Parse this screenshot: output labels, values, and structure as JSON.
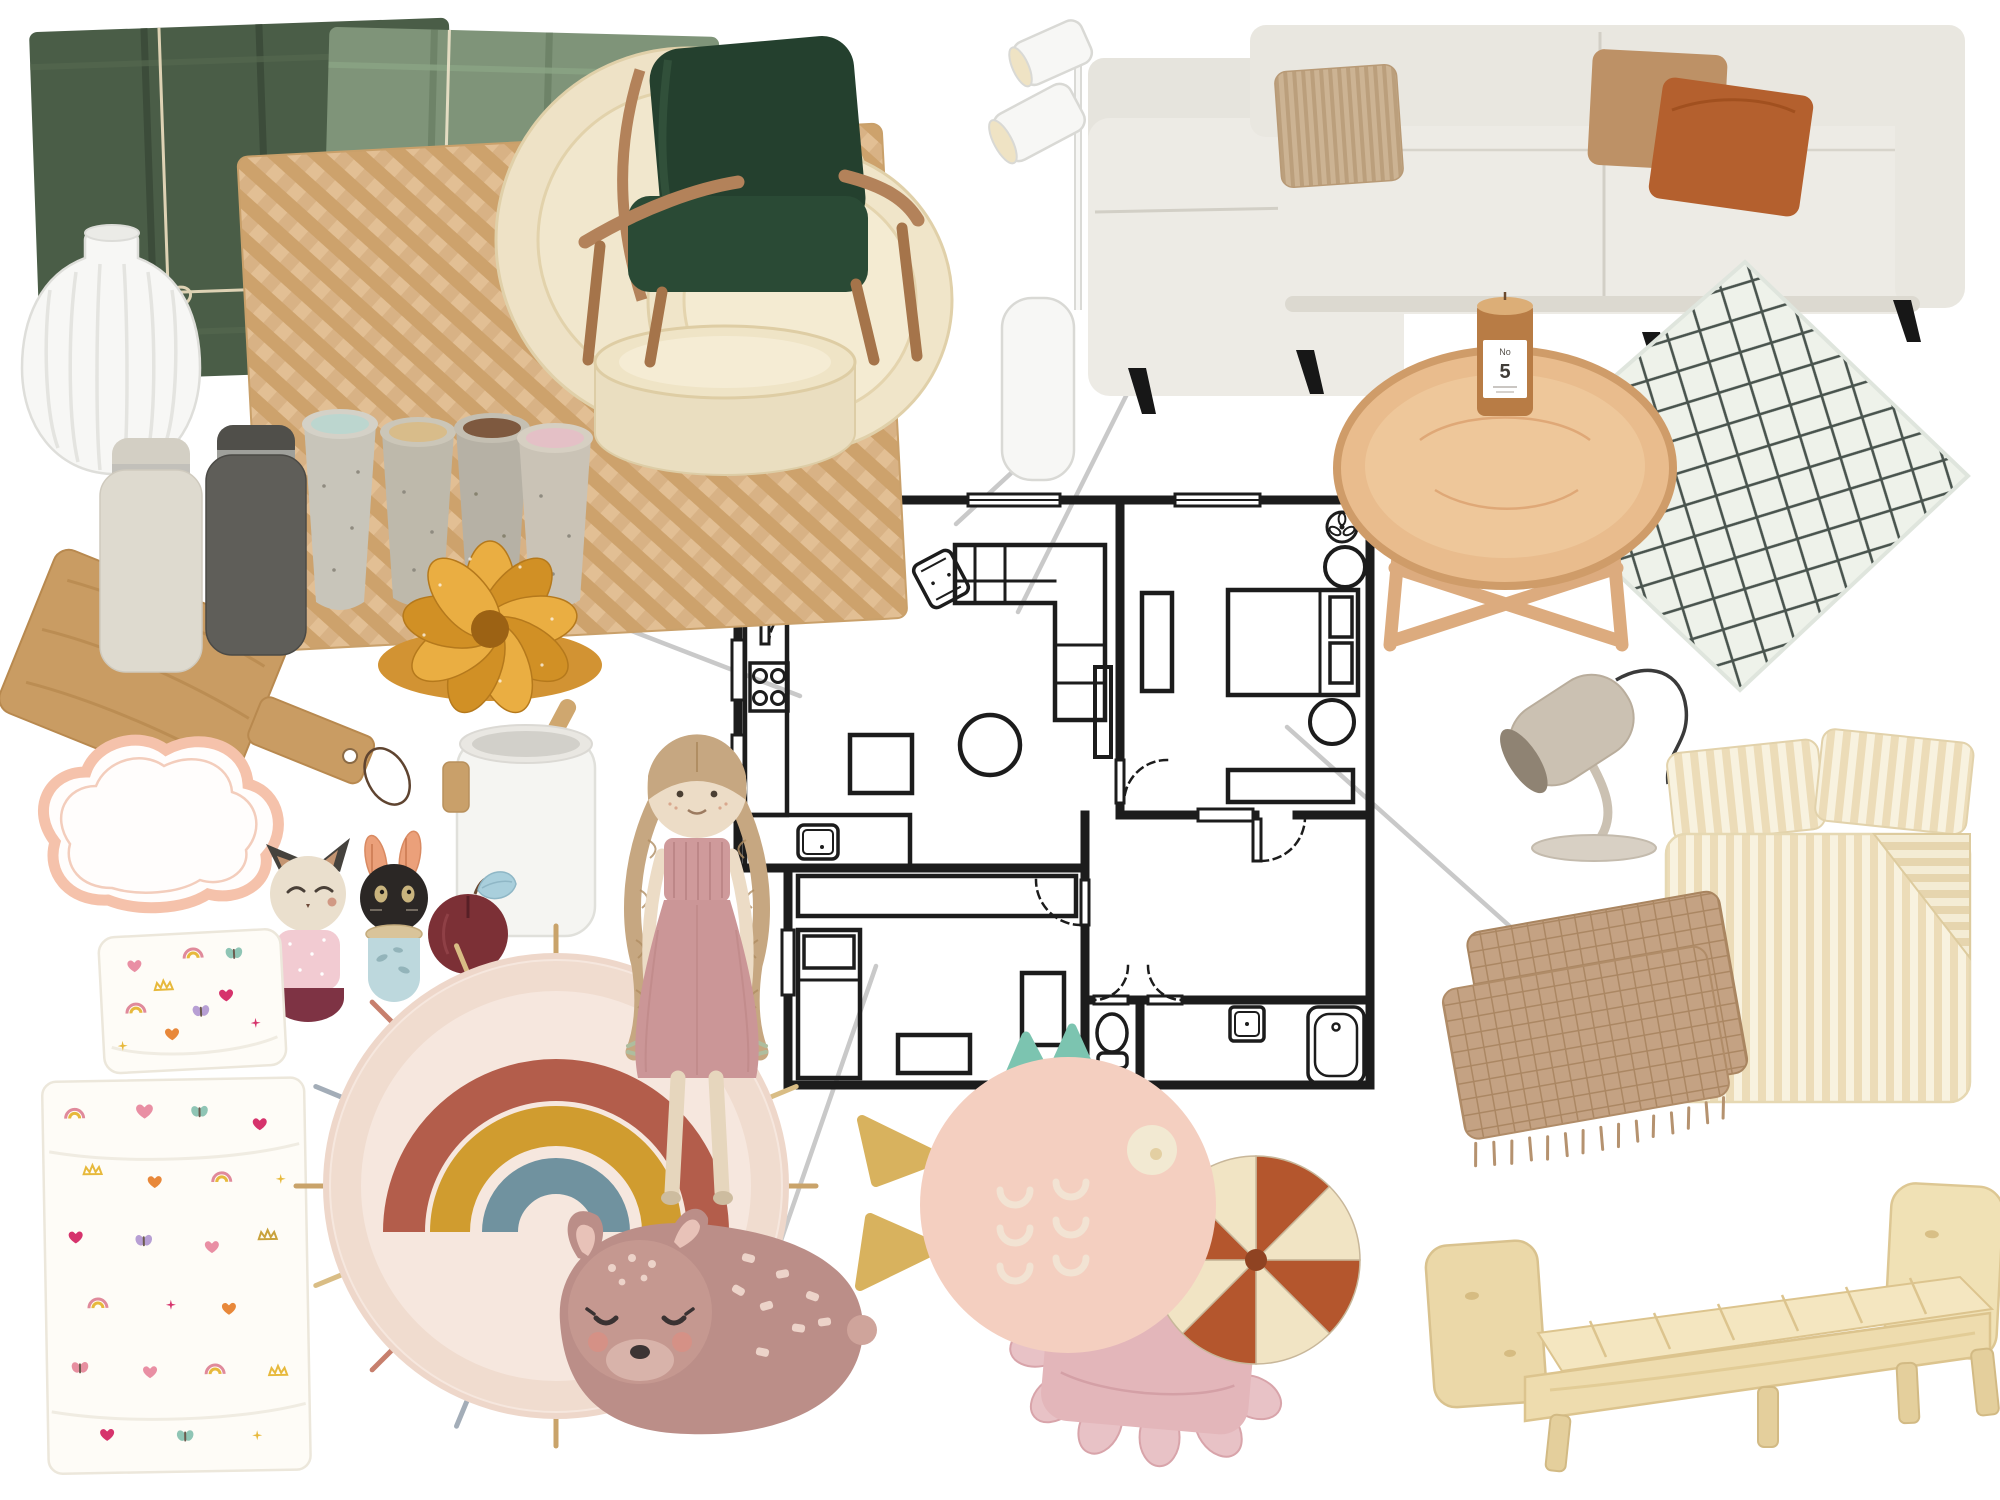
{
  "candle": {
    "label_top": "No",
    "label_number": "5"
  },
  "palette": {
    "background": "#ffffff",
    "connector": "#c9c9c9",
    "plan_line": "#1c1c1c",
    "napkin_dark": "#4a5d47",
    "napkin_sage": "#7f9479",
    "placemat": "#d8b285",
    "dinnerware_cream": "#eee2c6",
    "armchair_green": "#24402e",
    "armchair_wood": "#b3825a",
    "sofa": "#edebe5",
    "cushion_corduroy": "#ccb393",
    "cushion_brown": "#bd9166",
    "cushion_rust": "#b4602e",
    "rug_base": "#eef2ea",
    "rug_line": "#49544e",
    "table_wood": "#e9bc8d",
    "candle_glass": "#b87c45",
    "lamp_white": "#f7f7f5",
    "grinder_grey": "#5f5e59",
    "board_oak": "#c99c63",
    "bund_gold": "#e2a23e",
    "cloud_pink": "#f5c2ab",
    "toy_pink": "#f2cbd2",
    "toy_blue": "#bdd8dd",
    "rainbow_rust": "#b35d4b",
    "rainbow_mustard": "#d09c2f",
    "rainbow_blue": "#70929f",
    "doll_dress": "#cf9a9b",
    "deer_body": "#bb8e88",
    "fish_body": "#f4cfc0",
    "fish_fin": "#7cc4b0",
    "fish_tail": "#d8b25e",
    "ruffle_pink": "#e3b6ba",
    "patch_rust": "#b4562d",
    "patch_cream": "#f1e4c4",
    "desk_lamp": "#cbc1b2",
    "linen_stripe": "#ead9b5",
    "throw_tan": "#c2a07f",
    "bed_pine": "#eedcae"
  },
  "items": [
    {
      "id": "napkins",
      "label": "green velvet napkin bundles tied with twine"
    },
    {
      "id": "vase",
      "label": "white ribbed ceramic vase"
    },
    {
      "id": "placemat",
      "label": "woven seagrass placemat"
    },
    {
      "id": "dinnerware",
      "label": "cream stoneware plates and bowl"
    },
    {
      "id": "armchair",
      "label": "dark green velvet armchair with oak frame"
    },
    {
      "id": "floor-lamp",
      "label": "white two-spot floor lamp"
    },
    {
      "id": "sofa",
      "label": "light grey corner sofa with corduroy, brown and rust cushions"
    },
    {
      "id": "geometric-rug",
      "label": "mint rug with black trellis pattern"
    },
    {
      "id": "coffee-table",
      "label": "round oak tray coffee table"
    },
    {
      "id": "candle",
      "label": "amber glass scented candle No 5"
    },
    {
      "id": "cups",
      "label": "four speckled stoneware tumblers"
    },
    {
      "id": "grinders",
      "label": "salt and pepper mills"
    },
    {
      "id": "cutting-board",
      "label": "oak paddle cutting board with leather loop"
    },
    {
      "id": "bundt-cake",
      "label": "golden swirl bundt mold"
    },
    {
      "id": "utensil-holder",
      "label": "white utensil holder with wood hook"
    },
    {
      "id": "cloud-shelf",
      "label": "pink cloud wall shelf"
    },
    {
      "id": "wooden-toys",
      "label": "stacking wooden animal toys and apple"
    },
    {
      "id": "kids-pillow",
      "label": "pillowcase with hearts and rainbows print"
    },
    {
      "id": "kids-sheet",
      "label": "kids bed sheet with hearts and rainbows print"
    },
    {
      "id": "rainbow-rug",
      "label": "round rainbow rug with tassels"
    },
    {
      "id": "doll",
      "label": "rag doll with braids in dusty pink dress"
    },
    {
      "id": "deer-rug",
      "label": "sleeping fawn kids rug"
    },
    {
      "id": "fish-cushion",
      "label": "pink fish cushion with mint fins"
    },
    {
      "id": "ruffle-cushion",
      "label": "dusty pink ruffle cushion"
    },
    {
      "id": "patch-cushion",
      "label": "round patchwork cushion rust and cream"
    },
    {
      "id": "desk-lamp",
      "label": "greige desk lamp"
    },
    {
      "id": "bed-linen",
      "label": "striped cotton bed linen set"
    },
    {
      "id": "throw",
      "label": "beige waffle throw with fringe"
    },
    {
      "id": "bed",
      "label": "pine wood double bed frame"
    },
    {
      "id": "floor-plan",
      "label": "two bedroom apartment floor plan"
    }
  ],
  "floor_plan": {
    "rooms": [
      "dining room",
      "living room",
      "bedroom",
      "kitchen",
      "kids room",
      "wc",
      "bathroom",
      "hallway"
    ],
    "symbols": [
      "dining table with chairs",
      "corner sofa",
      "armchair",
      "round table",
      "tv stand",
      "double bed",
      "dressers",
      "ceiling fans",
      "kitchen counter with hob and sink",
      "single bed",
      "wardrobe",
      "desk",
      "toilet",
      "wash basin",
      "bathtub",
      "doors with swing arcs",
      "windows"
    ]
  }
}
